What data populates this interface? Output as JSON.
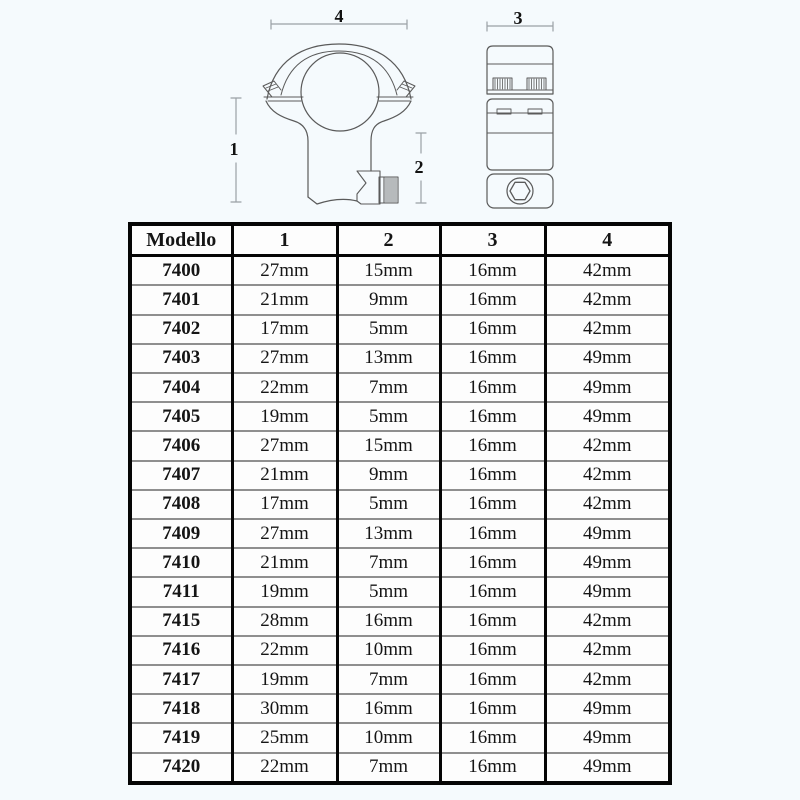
{
  "colors": {
    "background": "#f5fafd",
    "table_border": "#050505",
    "row_divider": "#8f8f8f",
    "drawing_line": "#5a5a5a",
    "dimension_line": "#9aa0a6"
  },
  "diagram": {
    "front_view": "scope-ring-front-view",
    "side_view": "scope-ring-side-view",
    "dimension_labels": {
      "d1": "1",
      "d2": "2",
      "d3": "3",
      "d4": "4"
    }
  },
  "table": {
    "headers": [
      "Modello",
      "1",
      "2",
      "3",
      "4"
    ],
    "rows": [
      [
        "7400",
        "27mm",
        "15mm",
        "16mm",
        "42mm"
      ],
      [
        "7401",
        "21mm",
        "9mm",
        "16mm",
        "42mm"
      ],
      [
        "7402",
        "17mm",
        "5mm",
        "16mm",
        "42mm"
      ],
      [
        "7403",
        "27mm",
        "13mm",
        "16mm",
        "49mm"
      ],
      [
        "7404",
        "22mm",
        "7mm",
        "16mm",
        "49mm"
      ],
      [
        "7405",
        "19mm",
        "5mm",
        "16mm",
        "49mm"
      ],
      [
        "7406",
        "27mm",
        "15mm",
        "16mm",
        "42mm"
      ],
      [
        "7407",
        "21mm",
        "9mm",
        "16mm",
        "42mm"
      ],
      [
        "7408",
        "17mm",
        "5mm",
        "16mm",
        "42mm"
      ],
      [
        "7409",
        "27mm",
        "13mm",
        "16mm",
        "49mm"
      ],
      [
        "7410",
        "21mm",
        "7mm",
        "16mm",
        "49mm"
      ],
      [
        "7411",
        "19mm",
        "5mm",
        "16mm",
        "49mm"
      ],
      [
        "7415",
        "28mm",
        "16mm",
        "16mm",
        "42mm"
      ],
      [
        "7416",
        "22mm",
        "10mm",
        "16mm",
        "42mm"
      ],
      [
        "7417",
        "19mm",
        "7mm",
        "16mm",
        "42mm"
      ],
      [
        "7418",
        "30mm",
        "16mm",
        "16mm",
        "49mm"
      ],
      [
        "7419",
        "25mm",
        "10mm",
        "16mm",
        "49mm"
      ],
      [
        "7420",
        "22mm",
        "7mm",
        "16mm",
        "49mm"
      ]
    ]
  }
}
